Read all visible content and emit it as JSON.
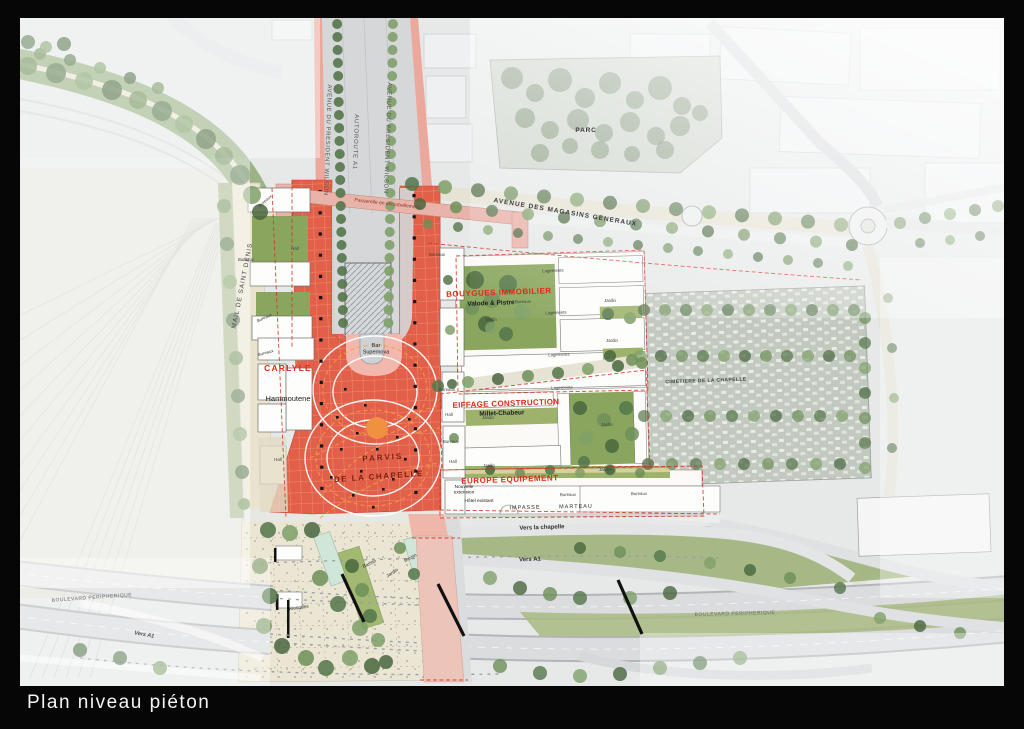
{
  "title": "Plan niveau piéton",
  "colors": {
    "frame_black": "#060606",
    "plaza_red": "#e2604a",
    "plaza_grid": "#ef8d74",
    "accent_red_text": "#e02b18",
    "orange_circle": "#ef9140",
    "tree_green": "#6d8f58",
    "garden_green": "#8aa65e",
    "street_cream": "#e9e3d0",
    "road_gray": "#dadcde",
    "pink_bridge": "#eab3a9",
    "bassin_mint": "#cfe6d8"
  },
  "map_labels": [
    {
      "id": "avenue-president-wilson-west",
      "text": "AVENUE DU PRESIDENT WILSON",
      "x": 306,
      "y": 122,
      "rot": 92,
      "size": 6,
      "color": "#575757",
      "spacing": 0.6
    },
    {
      "id": "autoroute-a1",
      "text": "AUTOROUTE A1",
      "x": 334,
      "y": 124,
      "rot": 92,
      "size": 6,
      "color": "#575757",
      "spacing": 0.8
    },
    {
      "id": "avenue-president-wilson-east",
      "text": "AVENUE DU PRESIDENT WILSON",
      "x": 366,
      "y": 120,
      "rot": 92,
      "size": 6,
      "color": "#575757",
      "spacing": 0.6
    },
    {
      "id": "passerelle",
      "text": "Passerelle en encorbellement",
      "x": 367,
      "y": 187,
      "rot": 6.5,
      "size": 5,
      "color": "#8a3a2a"
    },
    {
      "id": "avenue-magasins-generaux",
      "text": "AVENUE DES MAGASINS GENERAUX",
      "x": 545,
      "y": 196,
      "rot": 9.5,
      "size": 6.5,
      "color": "#3c3c3c",
      "spacing": 1,
      "weight": 700
    },
    {
      "id": "parc",
      "text": "PARC",
      "x": 566,
      "y": 114,
      "size": 6.5,
      "weight": 700,
      "color": "#3a3a3a",
      "spacing": 0.8
    },
    {
      "id": "mail-de-saint-denis",
      "text": "MAIL DE SAINT DENIS",
      "x": 224,
      "y": 268,
      "rot": -79,
      "size": 6.5,
      "color": "#4a4a4a",
      "spacing": 1
    },
    {
      "id": "cimetiere",
      "text": "CIMETIERE DE LA CHAPELLE",
      "x": 686,
      "y": 364,
      "rot": -2,
      "size": 5,
      "weight": 700,
      "color": "#3f4a42",
      "spacing": 0.4
    },
    {
      "id": "carlyle",
      "text": "CARLYLE",
      "x": 268,
      "y": 353,
      "size": 8.5,
      "weight": 700,
      "color": "#e02b18",
      "spacing": 1.2
    },
    {
      "id": "hammoutene",
      "text": "Hammoutene",
      "x": 268,
      "y": 383,
      "size": 7.5,
      "color": "#1d1d1d"
    },
    {
      "id": "bar-supernova",
      "lines": [
        "Bar",
        "Supernova"
      ],
      "x": 356,
      "y": 329,
      "size": 5.5,
      "color": "#222222"
    },
    {
      "id": "parvis-line1",
      "text": "PARVIS",
      "x": 363,
      "y": 442,
      "rot": -4,
      "size": 8,
      "weight": 700,
      "color": "#7d2012",
      "spacing": 2
    },
    {
      "id": "parvis-line2",
      "text": "DE LA CHAPELLE",
      "x": 359,
      "y": 461,
      "rot": -4,
      "size": 8,
      "weight": 700,
      "color": "#7d2012",
      "spacing": 1.5
    },
    {
      "id": "bouygues-immobilier",
      "text": "BOUYGUES IMMOBILIER",
      "x": 479,
      "y": 277,
      "rot": -2,
      "size": 8,
      "weight": 700,
      "color": "#e02b18",
      "spacing": 0.5
    },
    {
      "id": "valode-pistre",
      "text": "Valode & Pistre",
      "x": 471,
      "y": 287,
      "rot": -2,
      "size": 6.5,
      "weight": 700,
      "color": "#1d1d1d"
    },
    {
      "id": "eiffage-construction",
      "text": "EIFFAGE CONSTRUCTION",
      "x": 486,
      "y": 388,
      "rot": -2,
      "size": 8,
      "weight": 700,
      "color": "#e02b18",
      "spacing": 0.3
    },
    {
      "id": "millet-chabeur",
      "text": "Millet-Chabeur",
      "x": 482,
      "y": 397,
      "rot": -2,
      "size": 6.5,
      "weight": 700,
      "color": "#1d1d1d"
    },
    {
      "id": "europe-equipement",
      "text": "EUROPE EQUIPEMENT",
      "x": 490,
      "y": 464,
      "rot": -2,
      "size": 8,
      "weight": 700,
      "color": "#e02b18",
      "spacing": 0.5
    },
    {
      "id": "boulevard-peripherique-west",
      "text": "BOULEVARD PERIPHERIQUE",
      "x": 72,
      "y": 581,
      "rot": -4,
      "size": 5,
      "color": "#6b6b6b",
      "spacing": 0.5
    },
    {
      "id": "vers-a1-west",
      "text": "Vers A1",
      "x": 124,
      "y": 618,
      "rot": 10,
      "size": 5.5,
      "italic": true,
      "color": "#505050",
      "weight": 700
    },
    {
      "id": "boulevard-peripherique-east",
      "text": "BOULEVARD PERIPHERIQUE",
      "x": 715,
      "y": 597,
      "rot": -1.5,
      "size": 5,
      "color": "#6b6b6b",
      "spacing": 0.5
    },
    {
      "id": "impasse",
      "text": "IMPASSE",
      "x": 505,
      "y": 491,
      "rot": -1,
      "size": 5.5,
      "color": "#2e2e2e",
      "spacing": 1
    },
    {
      "id": "marteau",
      "text": "MARTEAU",
      "x": 556,
      "y": 490,
      "rot": -1,
      "size": 5.5,
      "color": "#2e2e2e",
      "spacing": 1
    },
    {
      "id": "vers-la-chapelle",
      "text": "Vers la chapelle",
      "x": 522,
      "y": 511,
      "rot": -2,
      "size": 6,
      "weight": 700,
      "color": "#2e2e2e"
    },
    {
      "id": "vers-a1-mid",
      "text": "Vers A1",
      "x": 510,
      "y": 543,
      "rot": -2,
      "size": 6,
      "weight": 700,
      "color": "#2e2e2e"
    },
    {
      "id": "hotel-existant",
      "text": "Hôtel existant",
      "x": 459,
      "y": 484,
      "size": 4.8,
      "color": "#222222"
    },
    {
      "id": "nouvelle-extension",
      "lines": [
        "Nouvelle",
        "extension"
      ],
      "x": 444,
      "y": 470,
      "size": 4.8,
      "color": "#222222"
    },
    {
      "id": "kiosques",
      "text": "Kiosques",
      "x": 279,
      "y": 591,
      "rot": -8,
      "size": 4.8,
      "color": "#333333"
    },
    {
      "id": "bassin-1",
      "text": "Bassin",
      "x": 350,
      "y": 547,
      "rot": -25,
      "size": 4.8,
      "color": "#333333"
    },
    {
      "id": "jardin-esplanade",
      "text": "Jardin",
      "x": 373,
      "y": 556,
      "rot": -33,
      "size": 4.8,
      "color": "#333333"
    },
    {
      "id": "bassin-2",
      "text": "Bassin",
      "x": 391,
      "y": 541,
      "rot": -28,
      "size": 4.5,
      "color": "#333333"
    }
  ],
  "unit_labels": [
    {
      "text": "Bureaux",
      "x": 246,
      "y": 184,
      "rot": -42
    },
    {
      "text": "Bureaux",
      "x": 226,
      "y": 243
    },
    {
      "text": "Bureaux",
      "x": 245,
      "y": 301,
      "rot": -25
    },
    {
      "text": "Bureaux",
      "x": 246,
      "y": 336,
      "rot": -15
    },
    {
      "text": "Bureaux",
      "x": 417,
      "y": 238
    },
    {
      "text": "Bureaux",
      "x": 503,
      "y": 285,
      "rot": -2
    },
    {
      "text": "Bureaux",
      "x": 427,
      "y": 373
    },
    {
      "text": "Bureaux",
      "x": 431,
      "y": 425
    },
    {
      "text": "Bureaux",
      "x": 548,
      "y": 478,
      "rot": -1
    },
    {
      "text": "Bureaux",
      "x": 619,
      "y": 477,
      "rot": -1
    },
    {
      "text": "Hall",
      "x": 275,
      "y": 232
    },
    {
      "text": "Hall",
      "x": 258,
      "y": 443
    },
    {
      "text": "Hall",
      "x": 429,
      "y": 398
    },
    {
      "text": "Hall",
      "x": 433,
      "y": 445
    },
    {
      "text": "Logements",
      "x": 533,
      "y": 254,
      "rot": -2
    },
    {
      "text": "Logements",
      "x": 536,
      "y": 296,
      "rot": -2
    },
    {
      "text": "Logements",
      "x": 539,
      "y": 338,
      "rot": -2
    },
    {
      "text": "Logements",
      "x": 542,
      "y": 371,
      "rot": -2
    },
    {
      "text": "Jardin",
      "x": 471,
      "y": 303
    },
    {
      "text": "Jardin",
      "x": 590,
      "y": 284
    },
    {
      "text": "Jardin",
      "x": 592,
      "y": 324
    },
    {
      "text": "Jardin",
      "x": 468,
      "y": 401
    },
    {
      "text": "Jardin",
      "x": 587,
      "y": 408
    },
    {
      "text": "Jardin",
      "x": 469,
      "y": 449
    },
    {
      "text": "Jardin",
      "x": 585,
      "y": 453
    }
  ]
}
